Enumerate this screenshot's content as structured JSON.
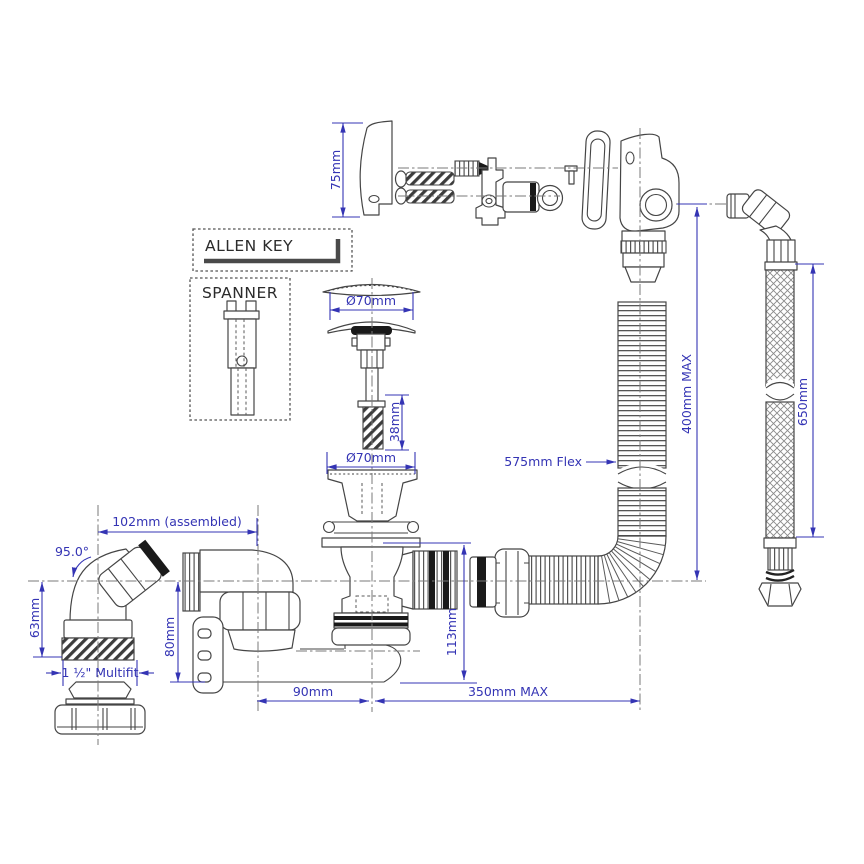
{
  "colors": {
    "dimension": "#3434b4",
    "linework": "#454545",
    "background": "#ffffff"
  },
  "boxes": {
    "allen_key": "ALLEN KEY",
    "spanner": "SPANNER"
  },
  "dims": {
    "overflow_height": "75mm",
    "plug_top_dia": "Ø70mm",
    "stud_length": "38mm",
    "plug_bottom_dia": "Ø70mm",
    "overflow_pipe_max": "400mm MAX",
    "flex_label": "575mm Flex",
    "hose_length": "650mm",
    "elbow_angle": "95.0°",
    "elbow_assembled": "102mm (assembled)",
    "elbow_drop": "63mm",
    "trap_inlet_drop": "80mm",
    "multifit": "1 ½\" Multifit",
    "waste_drop": "113mm",
    "pipe_run": "90mm",
    "outlet_run_max": "350mm MAX"
  }
}
